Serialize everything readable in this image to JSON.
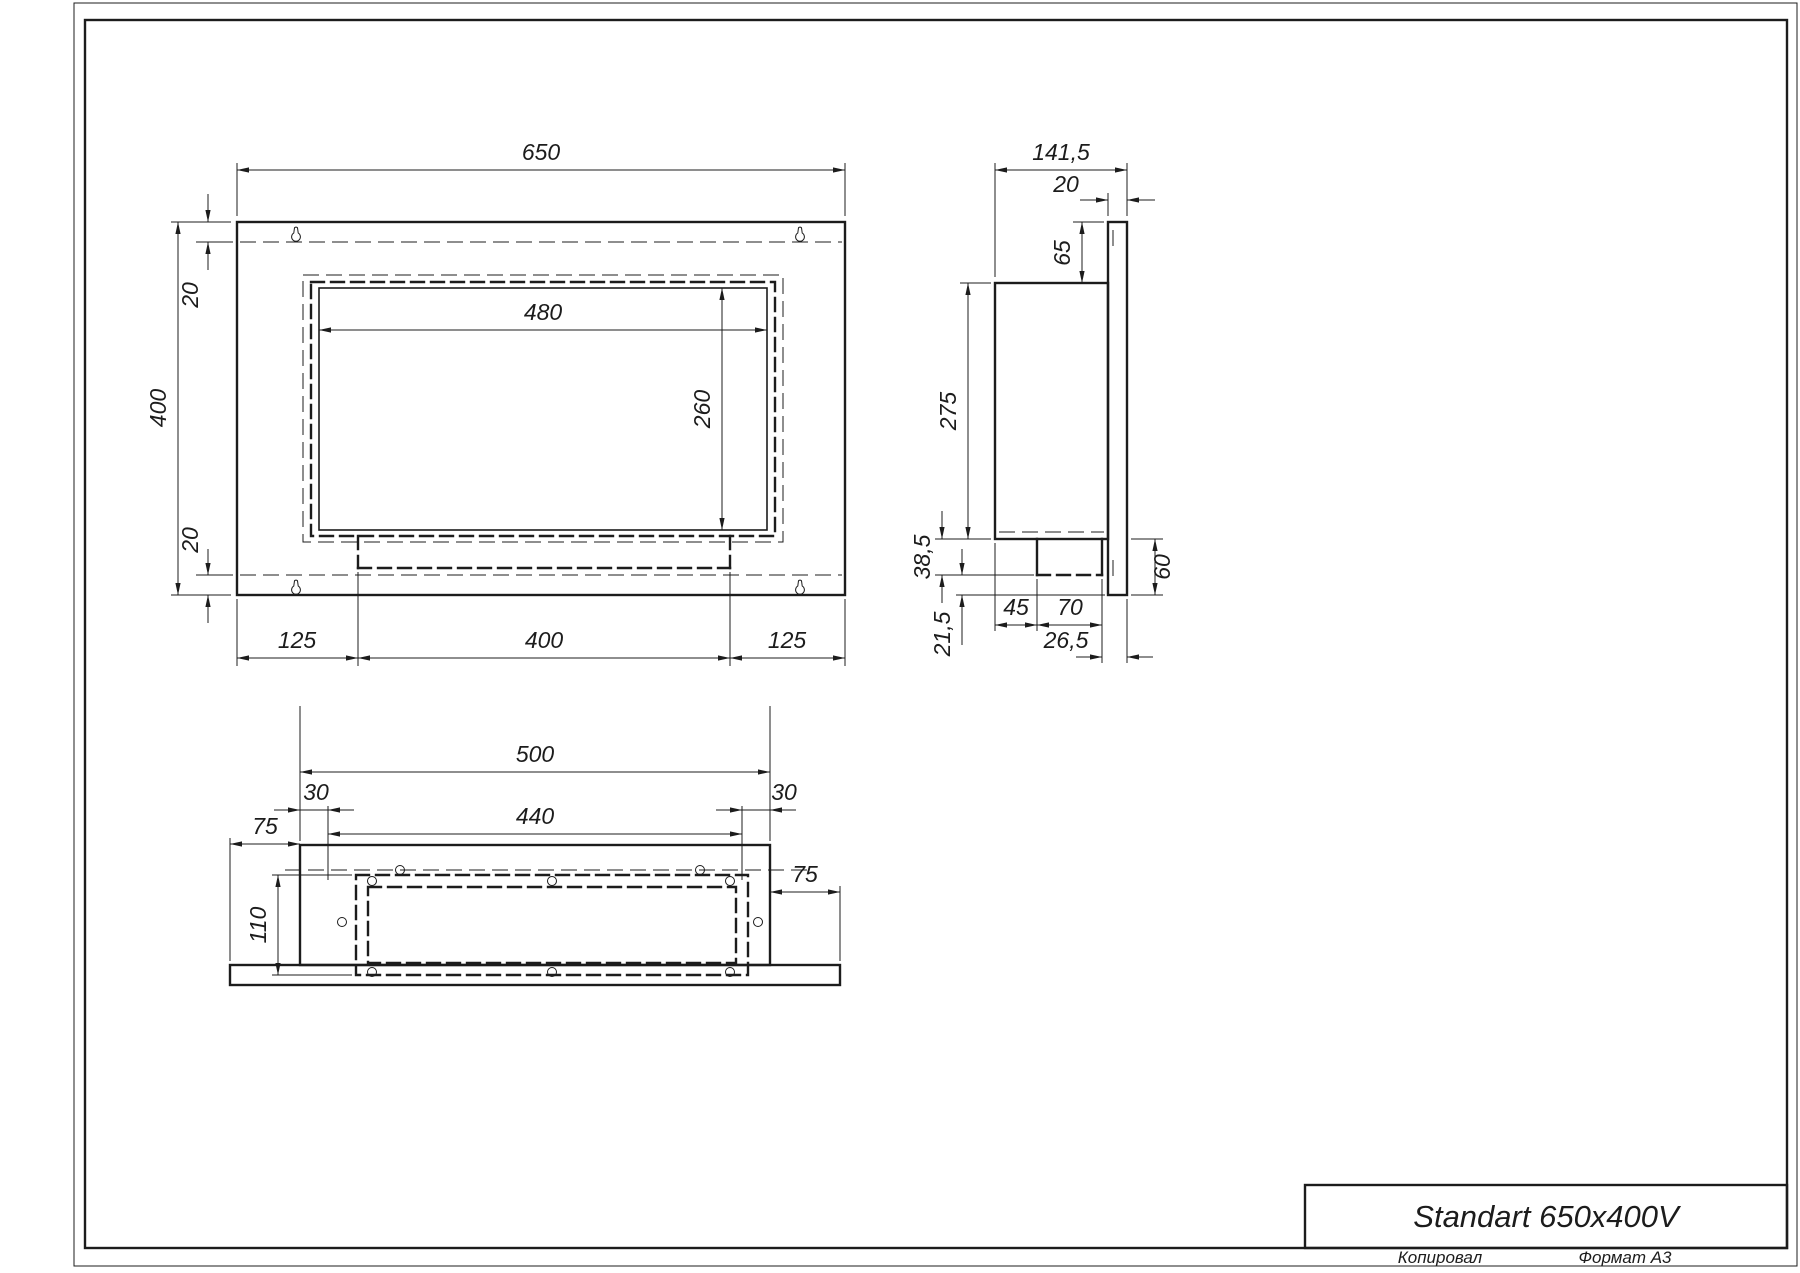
{
  "drawing": {
    "title": "Standart 650x400V",
    "footer": {
      "copied": "Копировал",
      "format": "Формат A3"
    },
    "line_color": "#1c1c1c",
    "front_view": {
      "total_width": "650",
      "total_height": "400",
      "top_inset": "20",
      "bottom_inset": "20",
      "opening_width": "480",
      "opening_height": "260",
      "bottom_left_offset": "125",
      "burner_width": "400",
      "bottom_right_offset": "125"
    },
    "side_view": {
      "total_depth": "141,5",
      "panel_thickness": "20",
      "top_offset": "65",
      "body_height": "275",
      "tray_drop": "38,5",
      "bottom_gap": "21,5",
      "tray_offset": "45",
      "tray_depth": "70",
      "panel_overhang": "26,5",
      "panel_bottom_extension": "60"
    },
    "bottom_view": {
      "body_width": "500",
      "side_inset_left": "30",
      "opening_width": "440",
      "side_inset_right": "30",
      "flange_left": "75",
      "flange_right": "75",
      "housing_depth": "110"
    }
  }
}
